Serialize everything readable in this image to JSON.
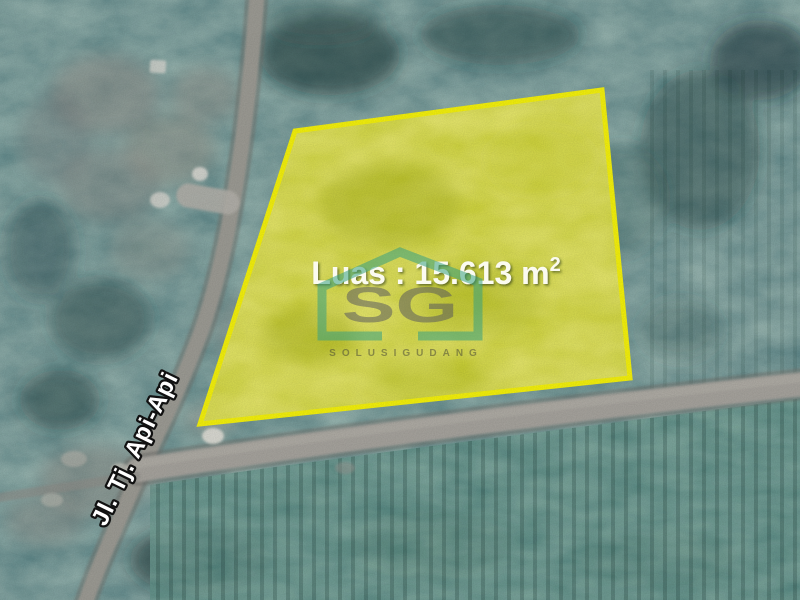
{
  "map": {
    "type_label": "satellite-land-listing-map"
  },
  "parcel": {
    "area_label": "Luas : 15.613 m",
    "area_superscript": "2",
    "outline_color": "#f4f10c",
    "fill_color": "#b5ba1a"
  },
  "road": {
    "label": "Jl. Tj. Api-Api"
  },
  "watermark": {
    "monogram": "SG",
    "subtext": "SOLUSIGUDANG",
    "house_color": "#37a182",
    "monogram_color": "#55555e"
  }
}
